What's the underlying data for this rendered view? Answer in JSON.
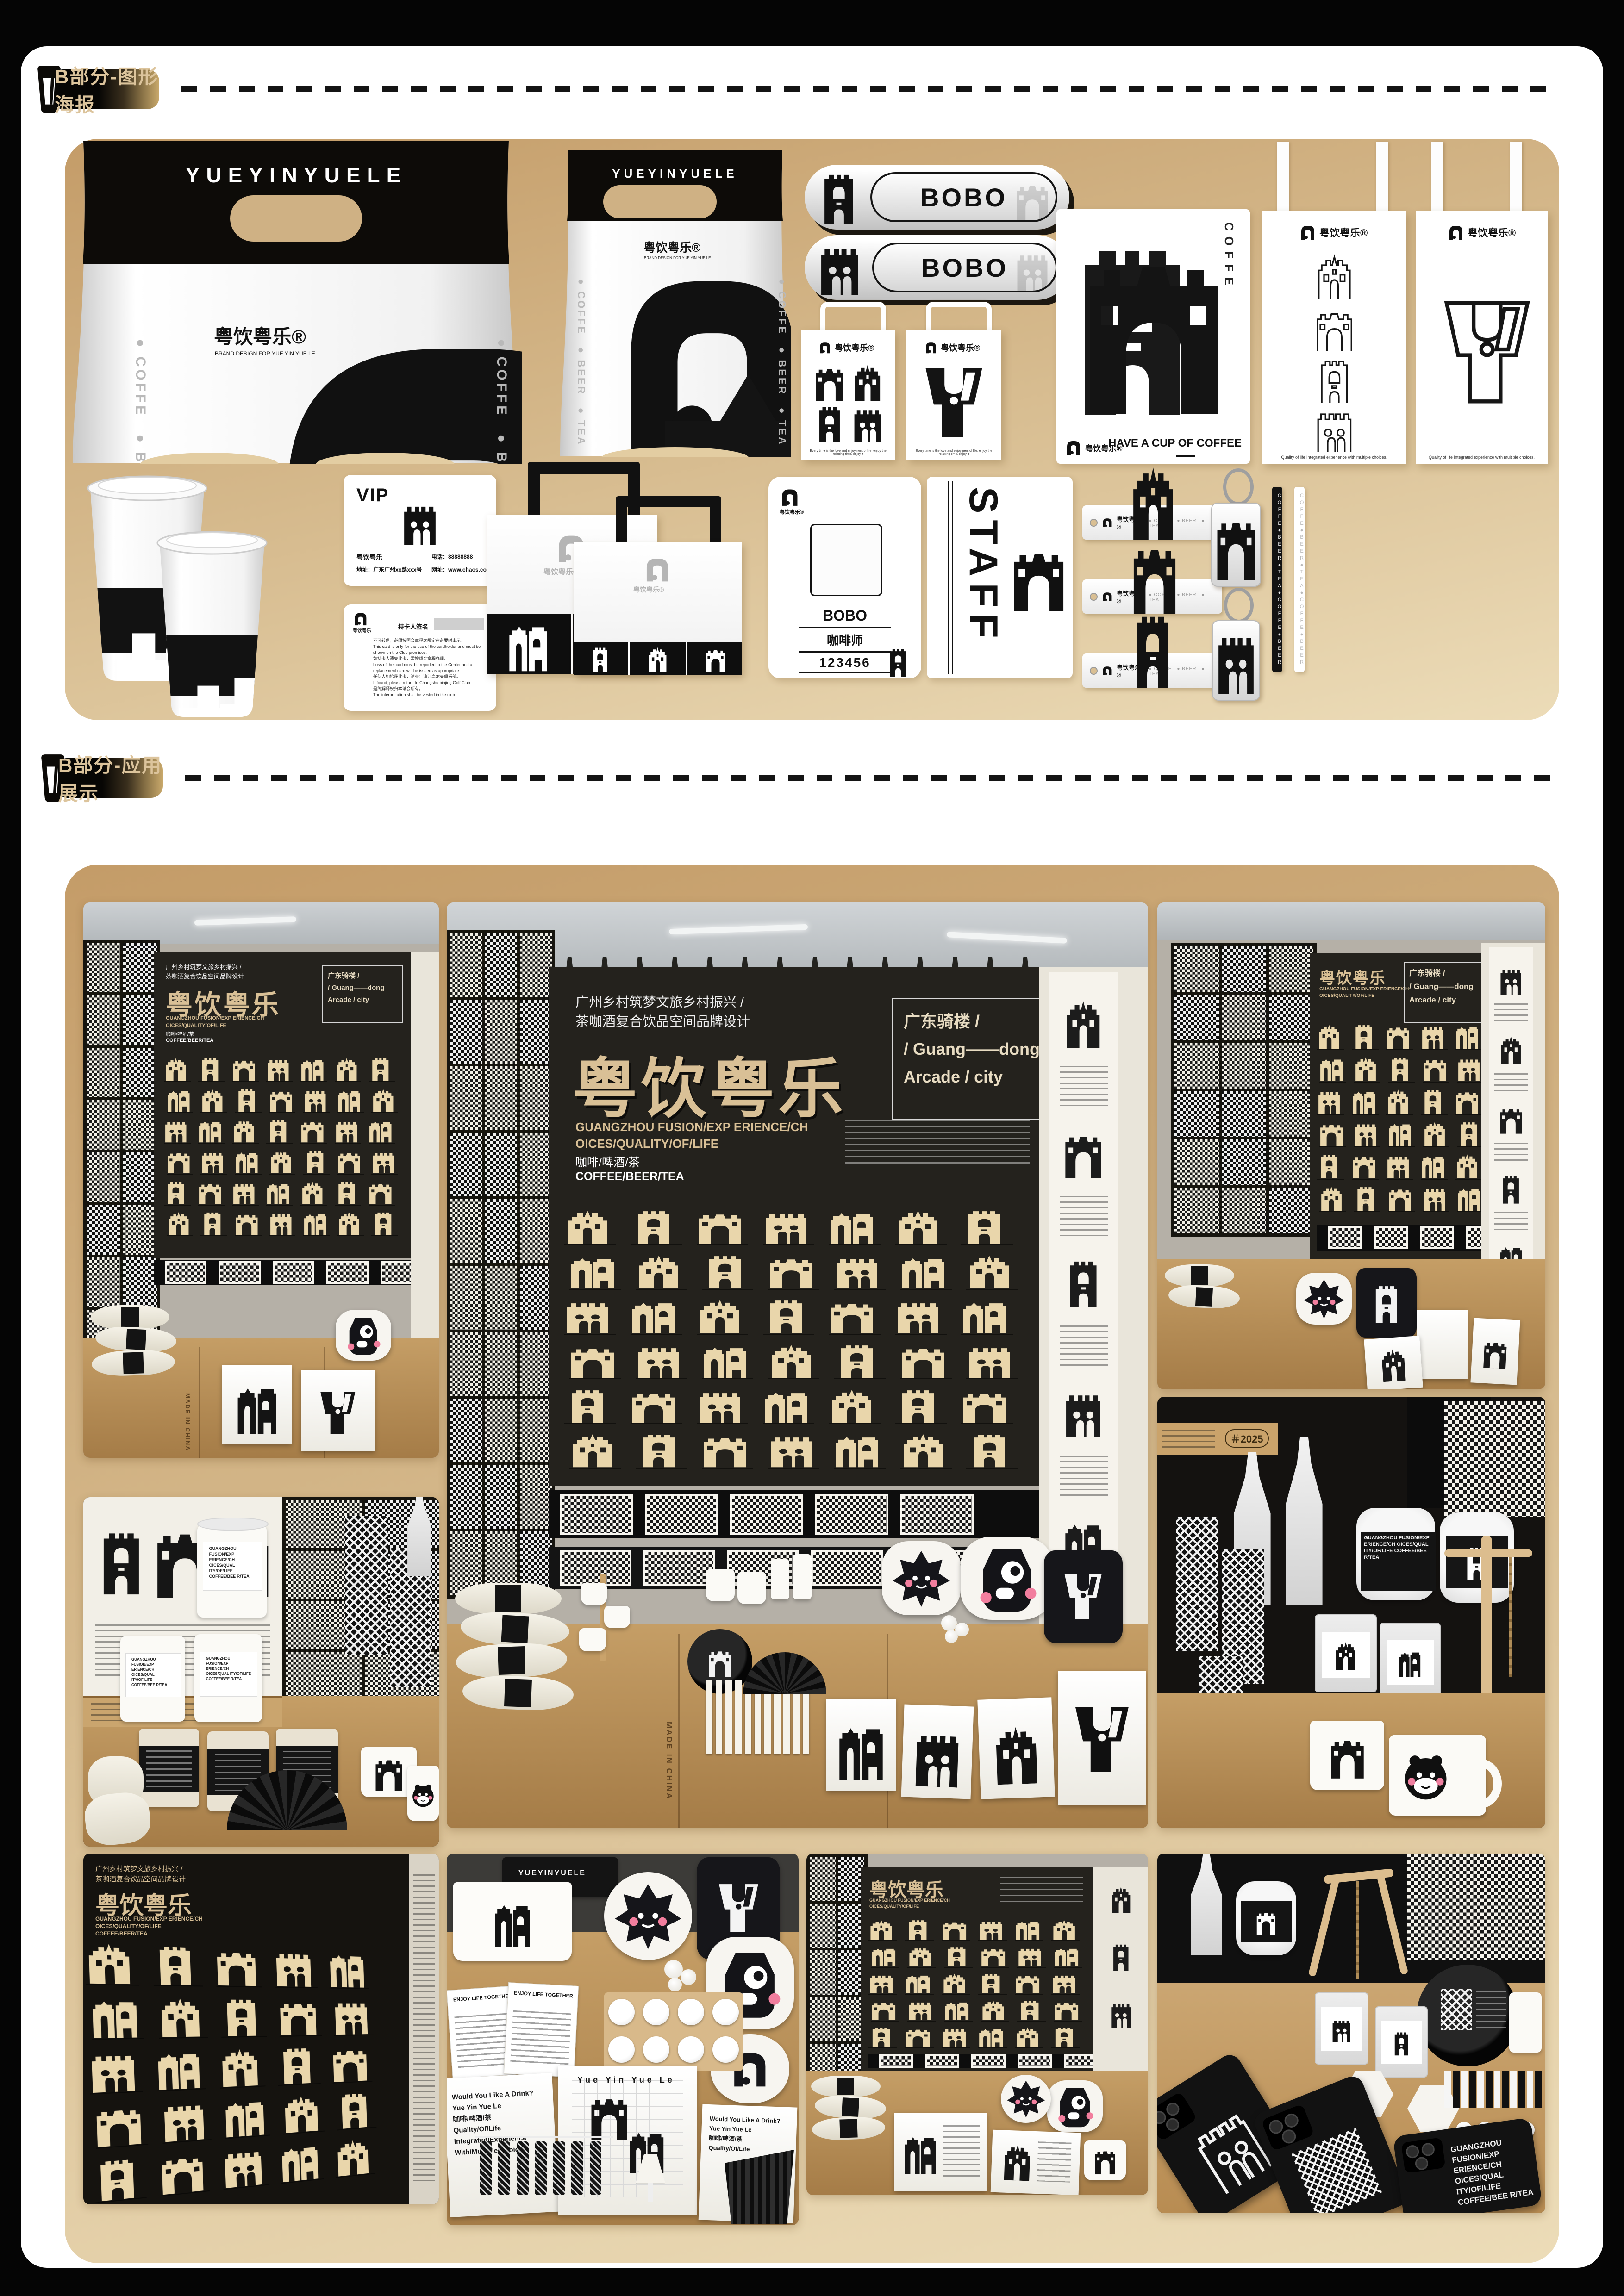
{
  "page": {
    "bg": "#050505",
    "paper": "#ffffff",
    "panel_gold_top": "#c49c68",
    "panel_gold_bottom": "#ecdcb8",
    "badge_text_color": "#dcc49c"
  },
  "sections": {
    "posters": {
      "badge": "B部分-图形海报"
    },
    "apps": {
      "badge": "B部分-应用展示"
    }
  },
  "brand": {
    "name_cn": "粤饮粤乐",
    "name_reg": "粤饮粤乐®",
    "name_en": "YUEYINYUELE",
    "subtitle_en": "BRAND DESIGN FOR YUE YIN YUE LE",
    "drink_list": "● COFFE　● BEER　● TEA",
    "drinks_cn": "咖啡/啤酒/茶",
    "drinks_en": "COFFEE/BEER/TEA"
  },
  "pill_badge": {
    "name": "BOBO"
  },
  "small_bags": {
    "caption": "Every time is the love and enjoyment of life, enjoy the relaxing time, enjoy it",
    "quality_caption": "Quality of life Integrated experience with multiple choices."
  },
  "coffee_card": {
    "vertical_word": "COFFE",
    "slogan": "HAVE A CUP OF COFFEE"
  },
  "vip_card": {
    "title": "VIP",
    "brand": "粤饮粤乐",
    "address": "地址：广东广州xx路xxx号",
    "phone": "电话：88888888",
    "website": "网址：www.chaos.com",
    "signature_label": "持卡人签名",
    "terms": [
      "不可转借，必须按照会章程之规定在必要时出示。",
      "This card is only for the use of the cardholder and must be shown on the Club premises.",
      "如持卡人遗失此卡，需按球会章程办理。",
      "Loss of the card must be reported to the Center and a replacement card will be issued as appropriate.",
      "任何人如拾获此卡，请交：滨江高尔夫俱乐部。",
      "If found, please return to Changshu binjing Golf Club.",
      "最终解释权归本球会所有。",
      "The interpretation shall be vested in the club."
    ]
  },
  "work_card": {
    "name": "BOBO",
    "role": "咖啡师",
    "number": "123456"
  },
  "staff_tag": {
    "label": "STAFF"
  },
  "wristband": {
    "drinks": "● COFFE　● BEER　● TEA"
  },
  "straw": {
    "loop": "COFFE●BEER●TEA●COFFE●BEER"
  },
  "booth": {
    "title_line1": "广州乡村筑梦文旅乡村振兴 /",
    "title_line2": "茶咖酒复合饮品空间品牌设计",
    "logotype": "粤饮粤乐",
    "en_line1": "GUANGZHOU FUSION/EXP ERIENCE/CH",
    "en_line2": "OICES/QUALITY/OF/LIFE",
    "arcade_line1": "广东骑楼 /",
    "arcade_line2": "/ Guang——dong",
    "arcade_line3": "Arcade / city",
    "sleeve_label": "GUANGZHOU FUSION/EXP ERIENCE/CH OICES/QUAL ITY/OF/LIFE COFFEE/BEE R/TEA",
    "tote_line1": "Would You Like A Drink?",
    "tote_line2": "Yue Yin Yue Le",
    "tote_line3": "咖啡/啤酒/茶",
    "tote_line4": "Quality/Of/Life",
    "tote_line5": "Integrated/Experience",
    "tote_line6": "With/Multiple/Choices",
    "notebook_title": "ENJOY LIFE TOGETHER",
    "made_in": "MADE IN CHINA",
    "ticket": "入场券",
    "year_tag": "＃2025"
  }
}
